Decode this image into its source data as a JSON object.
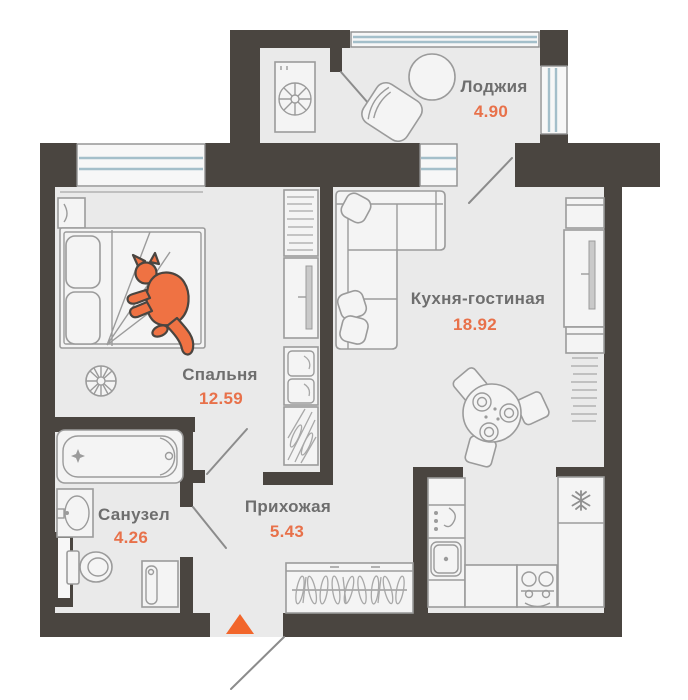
{
  "rooms": {
    "loggia": {
      "name": "Лоджия",
      "area": "4.90"
    },
    "kitchen_living": {
      "name": "Кухня-гостиная",
      "area": "18.92"
    },
    "bedroom": {
      "name": "Спальня",
      "area": "12.59"
    },
    "hallway": {
      "name": "Прихожая",
      "area": "5.43"
    },
    "bathroom": {
      "name": "Санузел",
      "area": "4.26"
    }
  },
  "entrance": {
    "marker": "orange-triangle-up",
    "location": "bottom-wall"
  },
  "furniture_inventory": [
    "double-bed",
    "orange-cat-on-bed",
    "nightstand",
    "potted-plant",
    "bookshelf",
    "tv-console",
    "shoe-cabinet",
    "shoe-rack",
    "bathtub",
    "wash-basin",
    "toilet",
    "bathroom-cabinet",
    "hallway-wardrobe-with-clothes",
    "corner-sofa-with-pillows",
    "round-dining-table-with-plates",
    "dining-chairs",
    "kitchen-counter",
    "coffee-machine",
    "kitchen-sink",
    "stove",
    "fridge-freezer",
    "tall-cabinet",
    "media-wall-tv",
    "media-shelf-books",
    "washing-machine",
    "loggia-armchair",
    "loggia-round-table"
  ],
  "colors": {
    "wall": "#4a4540",
    "floor": "#eaeaea",
    "furniture_line": "#9b9b9b",
    "window_glass": "#a4bfca",
    "room_label": "#6e6e6e",
    "area_number": "#e8714a",
    "entrance_marker": "#f2662b",
    "cat": "#ef7243"
  }
}
